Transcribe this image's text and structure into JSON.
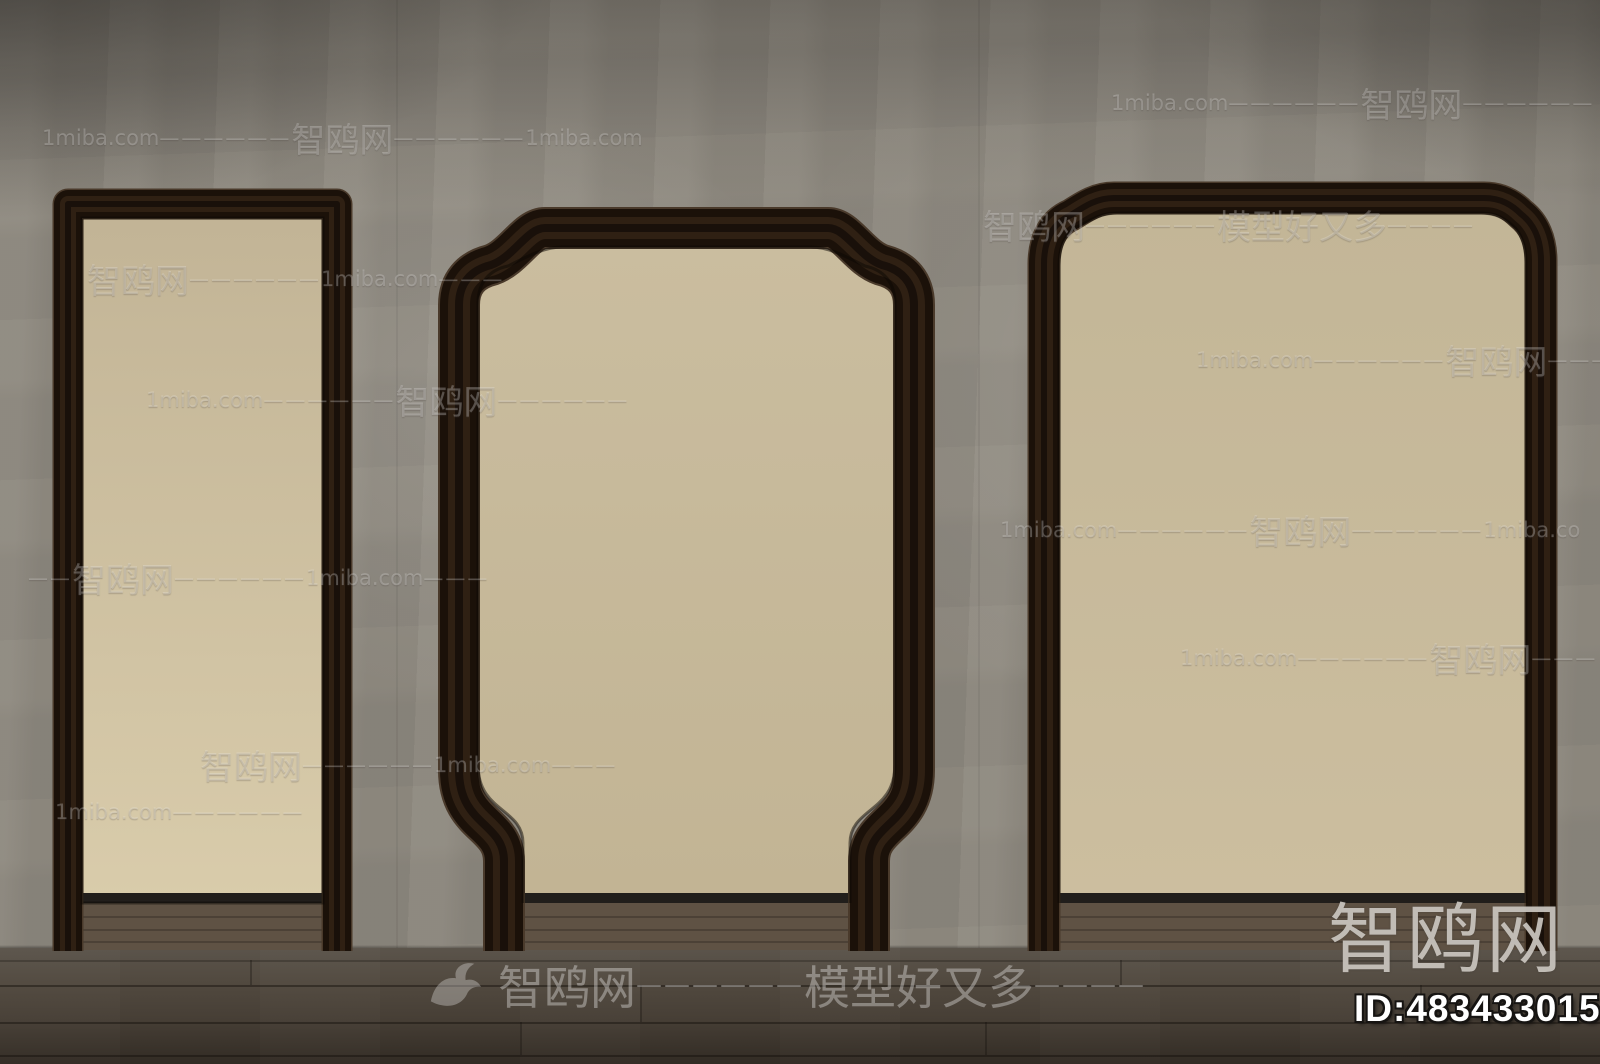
{
  "watermarks": {
    "rows": [
      {
        "x": 1111,
        "y": 100,
        "segments": [
          {
            "k": "lat",
            "t": "1miba.com"
          },
          {
            "k": "dash",
            "t": "——————"
          },
          {
            "k": "cjk",
            "t": "智鸥网"
          },
          {
            "k": "dash",
            "t": "——————"
          }
        ]
      },
      {
        "x": 42,
        "y": 135,
        "segments": [
          {
            "k": "lat",
            "t": "1miba.com"
          },
          {
            "k": "dash",
            "t": "——————"
          },
          {
            "k": "cjk",
            "t": "智鸥网"
          },
          {
            "k": "dash",
            "t": "——————"
          },
          {
            "k": "lat",
            "t": "1miba.com"
          }
        ]
      },
      {
        "x": 983,
        "y": 222,
        "segments": [
          {
            "k": "cjk",
            "t": "智鸥网"
          },
          {
            "k": "dash",
            "t": "——————"
          },
          {
            "k": "cjk",
            "t": "模型好又多"
          },
          {
            "k": "dash",
            "t": "————"
          }
        ]
      },
      {
        "x": 87,
        "y": 276,
        "segments": [
          {
            "k": "cjk",
            "t": "智鸥网"
          },
          {
            "k": "dash",
            "t": "——————"
          },
          {
            "k": "lat",
            "t": "1miba.com"
          },
          {
            "k": "dash",
            "t": "———"
          }
        ]
      },
      {
        "x": 1196,
        "y": 357,
        "segments": [
          {
            "k": "lat",
            "t": "1miba.com"
          },
          {
            "k": "dash",
            "t": "——————"
          },
          {
            "k": "cjk",
            "t": "智鸥网"
          },
          {
            "k": "dash",
            "t": "———"
          }
        ]
      },
      {
        "x": 146,
        "y": 397,
        "segments": [
          {
            "k": "lat",
            "t": "1miba.com"
          },
          {
            "k": "dash",
            "t": "——————"
          },
          {
            "k": "cjk",
            "t": "智鸥网"
          },
          {
            "k": "dash",
            "t": "——————"
          }
        ]
      },
      {
        "x": 1000,
        "y": 527,
        "segments": [
          {
            "k": "lat",
            "t": "1miba.com"
          },
          {
            "k": "dash",
            "t": "——————"
          },
          {
            "k": "cjk",
            "t": "智鸥网"
          },
          {
            "k": "dash",
            "t": "——————"
          },
          {
            "k": "lat",
            "t": "1miba.co"
          }
        ]
      },
      {
        "x": 28,
        "y": 575,
        "segments": [
          {
            "k": "dash",
            "t": "——"
          },
          {
            "k": "cjk",
            "t": "智鸥网"
          },
          {
            "k": "dash",
            "t": "——————"
          },
          {
            "k": "lat",
            "t": "1miba.com"
          },
          {
            "k": "dash",
            "t": "———"
          }
        ]
      },
      {
        "x": 1180,
        "y": 655,
        "segments": [
          {
            "k": "lat",
            "t": "1miba.com"
          },
          {
            "k": "dash",
            "t": "——————"
          },
          {
            "k": "cjk",
            "t": "智鸥网"
          },
          {
            "k": "dash",
            "t": "———"
          }
        ]
      },
      {
        "x": 200,
        "y": 762,
        "segments": [
          {
            "k": "cjk",
            "t": "智鸥网"
          },
          {
            "k": "dash",
            "t": "——————"
          },
          {
            "k": "lat",
            "t": "1miba.com"
          },
          {
            "k": "dash",
            "t": "———"
          }
        ]
      },
      {
        "x": 55,
        "y": 822,
        "segments": [
          {
            "k": "lat",
            "t": "1miba.com"
          },
          {
            "k": "dash",
            "t": "——————"
          }
        ]
      }
    ],
    "brand": {
      "icon": "bird-icon",
      "segments": [
        {
          "k": "cjk",
          "t": "智鸥网"
        },
        {
          "k": "dash",
          "t": "——————"
        },
        {
          "k": "cjk",
          "t": "模型好又多"
        },
        {
          "k": "dash",
          "t": "————"
        }
      ]
    },
    "corner": {
      "logo_text": "智鸥网",
      "id_text": "ID:483433015"
    }
  },
  "colors": {
    "wall": "#8e897f",
    "wall_dark": "#6e6a62",
    "wall_light": "#a49e93",
    "panel_left_top": "#c2b496",
    "panel_left_bottom": "#d9ccab",
    "panel_mid_top": "#cabd9f",
    "panel_mid_bottom": "#c2b494",
    "panel_right_top": "#c3b697",
    "panel_right_bottom": "#ccbe9f",
    "frame_rim": "#4a3a2b",
    "frame_dark": "#1b1109",
    "frame_mid": "#2f2013",
    "frame_core": "#19100a",
    "base_strip": "#211e1b",
    "floor_top": "#5b544b",
    "floor_mid": "#473f36",
    "floor_bottom": "#322b24",
    "floor_inner": "#5f5244",
    "watermark_white": "#ffffff",
    "logo_gray": "#cbc7c0",
    "id_white": "#ffffff"
  }
}
